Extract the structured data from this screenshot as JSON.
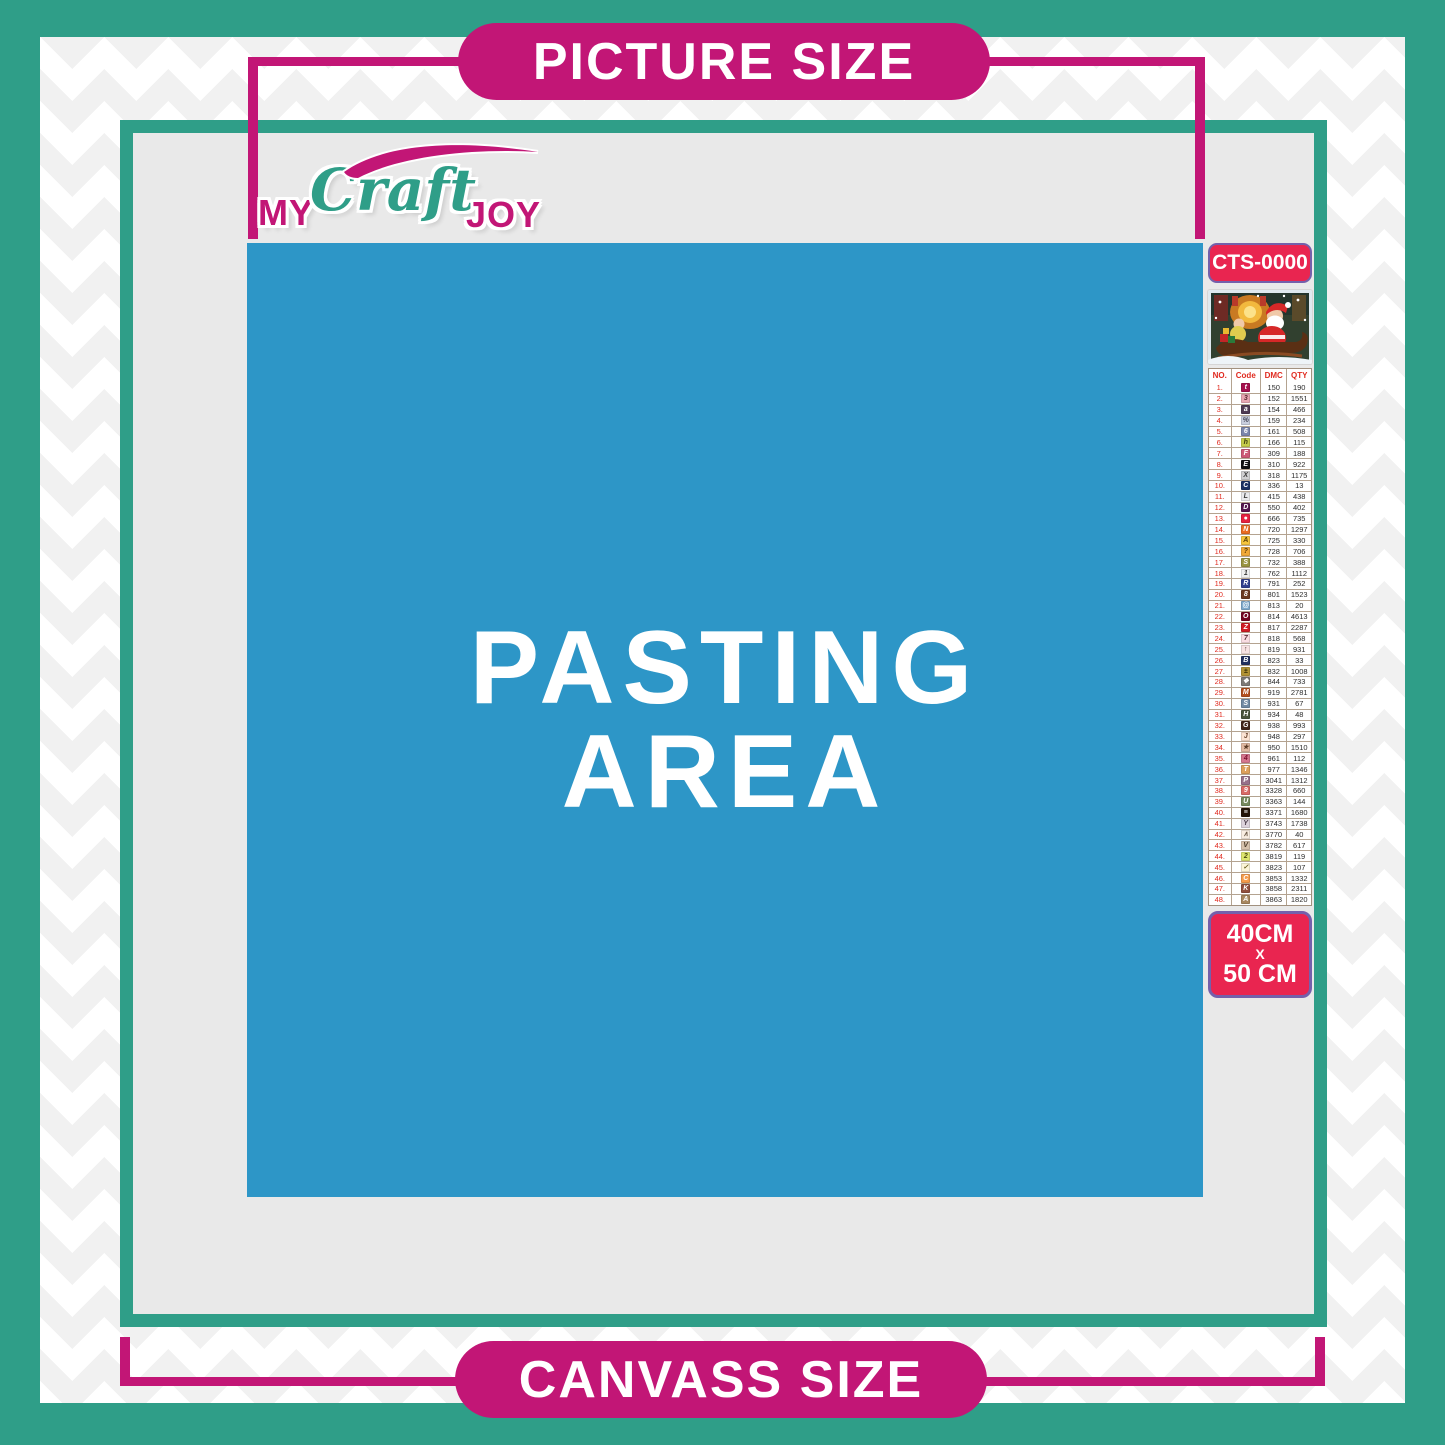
{
  "labels": {
    "picture_size": "PICTURE SIZE",
    "canvass_size": "CANVASS SIZE",
    "pasting_line1": "PASTING",
    "pasting_line2": "AREA"
  },
  "logo": {
    "my": "MY",
    "craft": "Craft",
    "joy": "JOY"
  },
  "colors": {
    "teal": "#2f9e88",
    "magenta": "#c21676",
    "pasting_blue": "#2d96c7",
    "badge_red": "#e92550",
    "badge_border_purple": "#7460ab",
    "canvas_gray": "#e9e9e9"
  },
  "side_panel": {
    "product_code": "CTS-0000",
    "thumbnail": "christmas-santa-sleigh-scene",
    "size_line1": "40CM",
    "size_line2": "X",
    "size_line3": "50 CM",
    "table": {
      "headers": [
        "NO.",
        "Code",
        "DMC",
        "QTY"
      ],
      "rows": [
        {
          "no": "1.",
          "symbol": "t",
          "chip_bg": "#a6104d",
          "chip_fg": "#ffffff",
          "dmc": "150",
          "qty": "190"
        },
        {
          "no": "2.",
          "symbol": "3",
          "chip_bg": "#e8a7b2",
          "chip_fg": "#5a2a33",
          "dmc": "152",
          "qty": "1551"
        },
        {
          "no": "3.",
          "symbol": "a",
          "chip_bg": "#4f3a52",
          "chip_fg": "#ffffff",
          "dmc": "154",
          "qty": "466"
        },
        {
          "no": "4.",
          "symbol": "%",
          "chip_bg": "#c9cede",
          "chip_fg": "#4a4a5a",
          "dmc": "159",
          "qty": "234"
        },
        {
          "no": "5.",
          "symbol": "6",
          "chip_bg": "#7c86ac",
          "chip_fg": "#ffffff",
          "dmc": "161",
          "qty": "508"
        },
        {
          "no": "6.",
          "symbol": "h",
          "chip_bg": "#c5cc4a",
          "chip_fg": "#3d3d10",
          "dmc": "166",
          "qty": "115"
        },
        {
          "no": "7.",
          "symbol": "F",
          "chip_bg": "#cd5a77",
          "chip_fg": "#ffffff",
          "dmc": "309",
          "qty": "188"
        },
        {
          "no": "8.",
          "symbol": "E",
          "chip_bg": "#111111",
          "chip_fg": "#ffffff",
          "dmc": "310",
          "qty": "922"
        },
        {
          "no": "9.",
          "symbol": "X",
          "chip_bg": "#cfcfd1",
          "chip_fg": "#3a3a3a",
          "dmc": "318",
          "qty": "1175"
        },
        {
          "no": "10.",
          "symbol": "C",
          "chip_bg": "#1d3263",
          "chip_fg": "#ffffff",
          "dmc": "336",
          "qty": "13"
        },
        {
          "no": "11.",
          "symbol": "L",
          "chip_bg": "#e9e9ec",
          "chip_fg": "#3a3a3a",
          "dmc": "415",
          "qty": "438"
        },
        {
          "no": "12.",
          "symbol": "D",
          "chip_bg": "#55164f",
          "chip_fg": "#ffffff",
          "dmc": "550",
          "qty": "402"
        },
        {
          "no": "13.",
          "symbol": "●",
          "chip_bg": "#e6213f",
          "chip_fg": "#ffffff",
          "dmc": "666",
          "qty": "735"
        },
        {
          "no": "14.",
          "symbol": "N",
          "chip_bg": "#ea6c23",
          "chip_fg": "#ffffff",
          "dmc": "720",
          "qty": "1297"
        },
        {
          "no": "15.",
          "symbol": "A",
          "chip_bg": "#f6c53e",
          "chip_fg": "#5a4008",
          "dmc": "725",
          "qty": "330"
        },
        {
          "no": "16.",
          "symbol": "?",
          "chip_bg": "#f0a939",
          "chip_fg": "#5a3c08",
          "dmc": "728",
          "qty": "706"
        },
        {
          "no": "17.",
          "symbol": "S",
          "chip_bg": "#9a9440",
          "chip_fg": "#ffffff",
          "dmc": "732",
          "qty": "388"
        },
        {
          "no": "18.",
          "symbol": "1",
          "chip_bg": "#efefef",
          "chip_fg": "#3a3a3a",
          "dmc": "762",
          "qty": "1112"
        },
        {
          "no": "19.",
          "symbol": "R",
          "chip_bg": "#32418f",
          "chip_fg": "#ffffff",
          "dmc": "791",
          "qty": "252"
        },
        {
          "no": "20.",
          "symbol": "8",
          "chip_bg": "#6b3a22",
          "chip_fg": "#ffffff",
          "dmc": "801",
          "qty": "1523"
        },
        {
          "no": "21.",
          "symbol": "@",
          "chip_bg": "#7fa9cc",
          "chip_fg": "#ffffff",
          "dmc": "813",
          "qty": "20"
        },
        {
          "no": "22.",
          "symbol": "O",
          "chip_bg": "#73051f",
          "chip_fg": "#ffffff",
          "dmc": "814",
          "qty": "4613"
        },
        {
          "no": "23.",
          "symbol": "Z",
          "chip_bg": "#d11c24",
          "chip_fg": "#ffffff",
          "dmc": "817",
          "qty": "2287"
        },
        {
          "no": "24.",
          "symbol": "7",
          "chip_bg": "#f9dde2",
          "chip_fg": "#5a3038",
          "dmc": "818",
          "qty": "568"
        },
        {
          "no": "25.",
          "symbol": "↑",
          "chip_bg": "#f7e2e2",
          "chip_fg": "#5a4040",
          "dmc": "819",
          "qty": "931"
        },
        {
          "no": "26.",
          "symbol": "B",
          "chip_bg": "#22305e",
          "chip_fg": "#ffffff",
          "dmc": "823",
          "qty": "33"
        },
        {
          "no": "27.",
          "symbol": "±",
          "chip_bg": "#b29335",
          "chip_fg": "#2e2705",
          "dmc": "832",
          "qty": "1008"
        },
        {
          "no": "28.",
          "symbol": "❖",
          "chip_bg": "#7d7a76",
          "chip_fg": "#ffffff",
          "dmc": "844",
          "qty": "733"
        },
        {
          "no": "29.",
          "symbol": "M",
          "chip_bg": "#b34f1d",
          "chip_fg": "#ffffff",
          "dmc": "919",
          "qty": "2781"
        },
        {
          "no": "30.",
          "symbol": "S",
          "chip_bg": "#7189a3",
          "chip_fg": "#ffffff",
          "dmc": "931",
          "qty": "67"
        },
        {
          "no": "31.",
          "symbol": "H",
          "chip_bg": "#49543c",
          "chip_fg": "#ffffff",
          "dmc": "934",
          "qty": "48"
        },
        {
          "no": "32.",
          "symbol": "G",
          "chip_bg": "#42261a",
          "chip_fg": "#ffffff",
          "dmc": "938",
          "qty": "993"
        },
        {
          "no": "33.",
          "symbol": "J",
          "chip_bg": "#fbe3d3",
          "chip_fg": "#6b4630",
          "dmc": "948",
          "qty": "297"
        },
        {
          "no": "34.",
          "symbol": "★",
          "chip_bg": "#e2bba4",
          "chip_fg": "#5a3c28",
          "dmc": "950",
          "qty": "1510"
        },
        {
          "no": "35.",
          "symbol": "4",
          "chip_bg": "#d5768e",
          "chip_fg": "#7b1030",
          "dmc": "961",
          "qty": "112"
        },
        {
          "no": "36.",
          "symbol": "T",
          "chip_bg": "#dda05c",
          "chip_fg": "#ffffff",
          "dmc": "977",
          "qty": "1346"
        },
        {
          "no": "37.",
          "symbol": "P",
          "chip_bg": "#97718a",
          "chip_fg": "#ffffff",
          "dmc": "3041",
          "qty": "1312"
        },
        {
          "no": "38.",
          "symbol": "9",
          "chip_bg": "#d96a66",
          "chip_fg": "#ffffff",
          "dmc": "3328",
          "qty": "660"
        },
        {
          "no": "39.",
          "symbol": "U",
          "chip_bg": "#778a5d",
          "chip_fg": "#ffffff",
          "dmc": "3363",
          "qty": "144"
        },
        {
          "no": "40.",
          "symbol": "≡",
          "chip_bg": "#241408",
          "chip_fg": "#ffffff",
          "dmc": "3371",
          "qty": "1680"
        },
        {
          "no": "41.",
          "symbol": "Y",
          "chip_bg": "#dcd2dc",
          "chip_fg": "#4a3c4a",
          "dmc": "3743",
          "qty": "1738"
        },
        {
          "no": "42.",
          "symbol": "∧",
          "chip_bg": "#f8eee2",
          "chip_fg": "#6b5a48",
          "dmc": "3770",
          "qty": "40"
        },
        {
          "no": "43.",
          "symbol": "V",
          "chip_bg": "#d6c1ab",
          "chip_fg": "#4a3a28",
          "dmc": "3782",
          "qty": "617"
        },
        {
          "no": "44.",
          "symbol": "2",
          "chip_bg": "#dde56e",
          "chip_fg": "#4a4a10",
          "dmc": "3819",
          "qty": "119"
        },
        {
          "no": "45.",
          "symbol": "✓",
          "chip_bg": "#fcf5d8",
          "chip_fg": "#6b6020",
          "dmc": "3823",
          "qty": "107"
        },
        {
          "no": "46.",
          "symbol": "C",
          "chip_bg": "#f59c4c",
          "chip_fg": "#ffffff",
          "dmc": "3853",
          "qty": "1332"
        },
        {
          "no": "47.",
          "symbol": "K",
          "chip_bg": "#91503e",
          "chip_fg": "#ffffff",
          "dmc": "3858",
          "qty": "2311"
        },
        {
          "no": "48.",
          "symbol": "A",
          "chip_bg": "#a8875f",
          "chip_fg": "#ffffff",
          "dmc": "3863",
          "qty": "1820"
        }
      ]
    }
  }
}
